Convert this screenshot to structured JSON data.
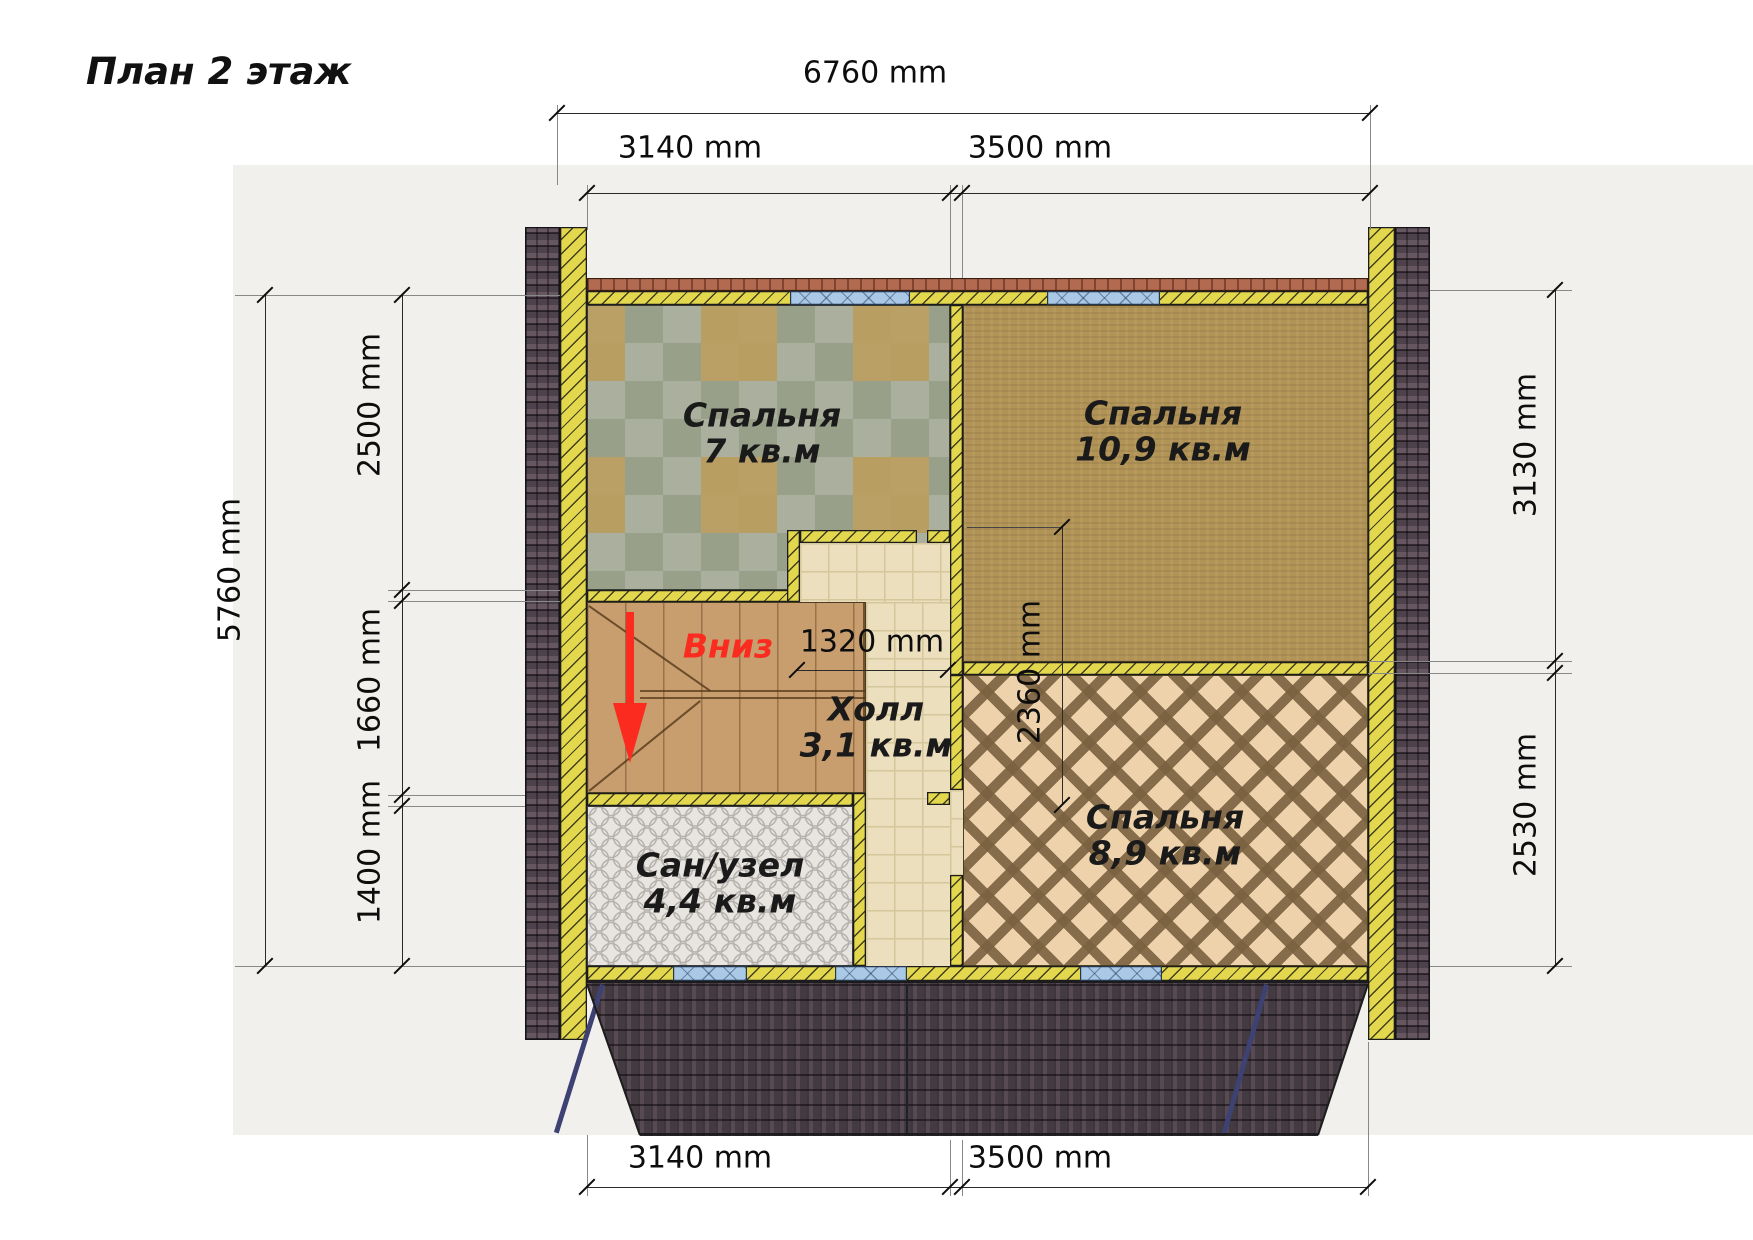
{
  "title": "План 2 этаж",
  "dims": {
    "top_total": "6760 mm",
    "top_seg1": "3140 mm",
    "top_seg2": "3500 mm",
    "bottom_seg1": "3140 mm",
    "bottom_seg2": "3500 mm",
    "left_total": "5760 mm",
    "left_seg1": "2500 mm",
    "left_seg2": "1660 mm",
    "left_seg3": "1400 mm",
    "right_seg1": "3130 mm",
    "right_seg2": "2530 mm",
    "hall_width": "1320 mm",
    "inner_depth": "2360 mm"
  },
  "rooms": {
    "bedroom1": {
      "name": "Спальня",
      "area": "7 кв.м"
    },
    "bedroom2": {
      "name": "Спальня",
      "area": "10,9 кв.м"
    },
    "hall": {
      "name": "Холл",
      "area": "3,1 кв.м"
    },
    "bathroom": {
      "name": "Сан/узел",
      "area": "4,4 кв.м"
    },
    "bedroom3": {
      "name": "Спальня",
      "area": "8,9 кв.м"
    }
  },
  "stairs": {
    "direction_label": "Вниз"
  },
  "colors": {
    "wall_yellow": "#e2d74d",
    "window_blue": "#a9c9e6",
    "roof_band_red": "#b26a50",
    "shingle_dark": "#4c4349",
    "arrow_red": "#fb2b20",
    "panel_bg": "#f2f0ec"
  }
}
